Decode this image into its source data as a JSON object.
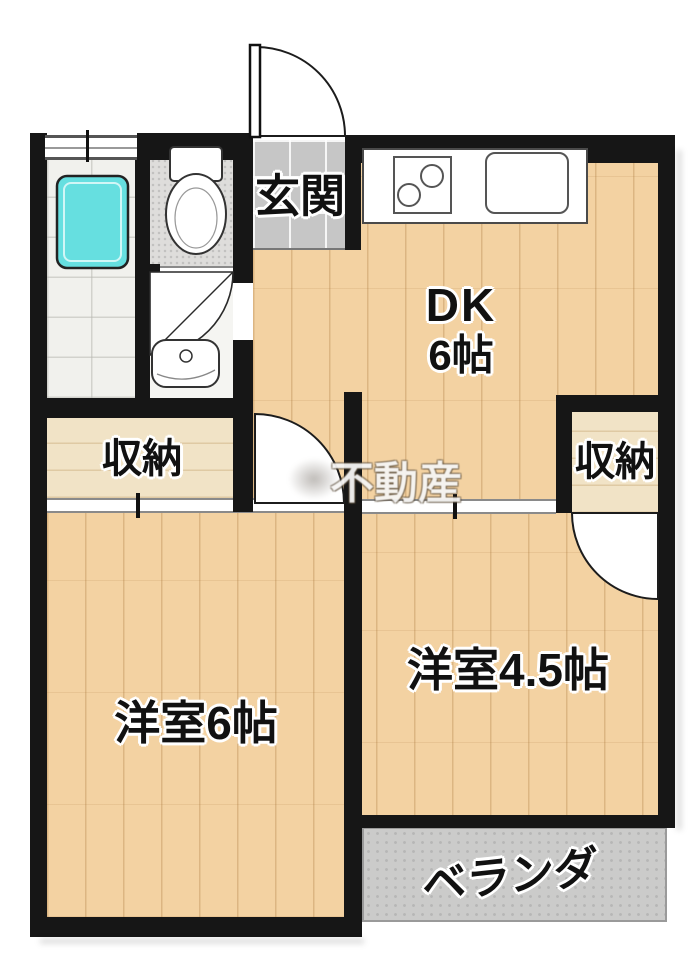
{
  "floorplan": {
    "type": "apartment-floor-plan",
    "layout": "2DK",
    "rooms": {
      "genkan": {
        "label": "玄関"
      },
      "dk": {
        "name": "DK",
        "size": "6帖"
      },
      "closet_left": {
        "label": "収納"
      },
      "closet_right": {
        "label": "収納"
      },
      "western_room_6": {
        "label": "洋室6帖"
      },
      "western_room_45": {
        "label": "洋室4.5帖"
      },
      "veranda": {
        "label": "ベランダ"
      }
    },
    "watermark": {
      "text": "不動産"
    },
    "fixtures": [
      "bathtub",
      "toilet",
      "washbasin",
      "kitchen-stove",
      "kitchen-sink",
      "entrance-door",
      "window",
      "door-swing",
      "sliding-door"
    ],
    "colors": {
      "wall": "#161616",
      "wood_floor": "#f3d2a2",
      "closet_floor": "#f1e3c6",
      "genkan_tile": "#c6c6c6",
      "bath_floor": "#f1f1ed",
      "toilet_floor": "#dedddb",
      "washroom_floor": "#f5f5f2",
      "veranda_floor": "#cbcbca",
      "bathtub": "#66dfe0",
      "sliding_line": "#8a8a8a",
      "background": "#ffffff"
    }
  }
}
